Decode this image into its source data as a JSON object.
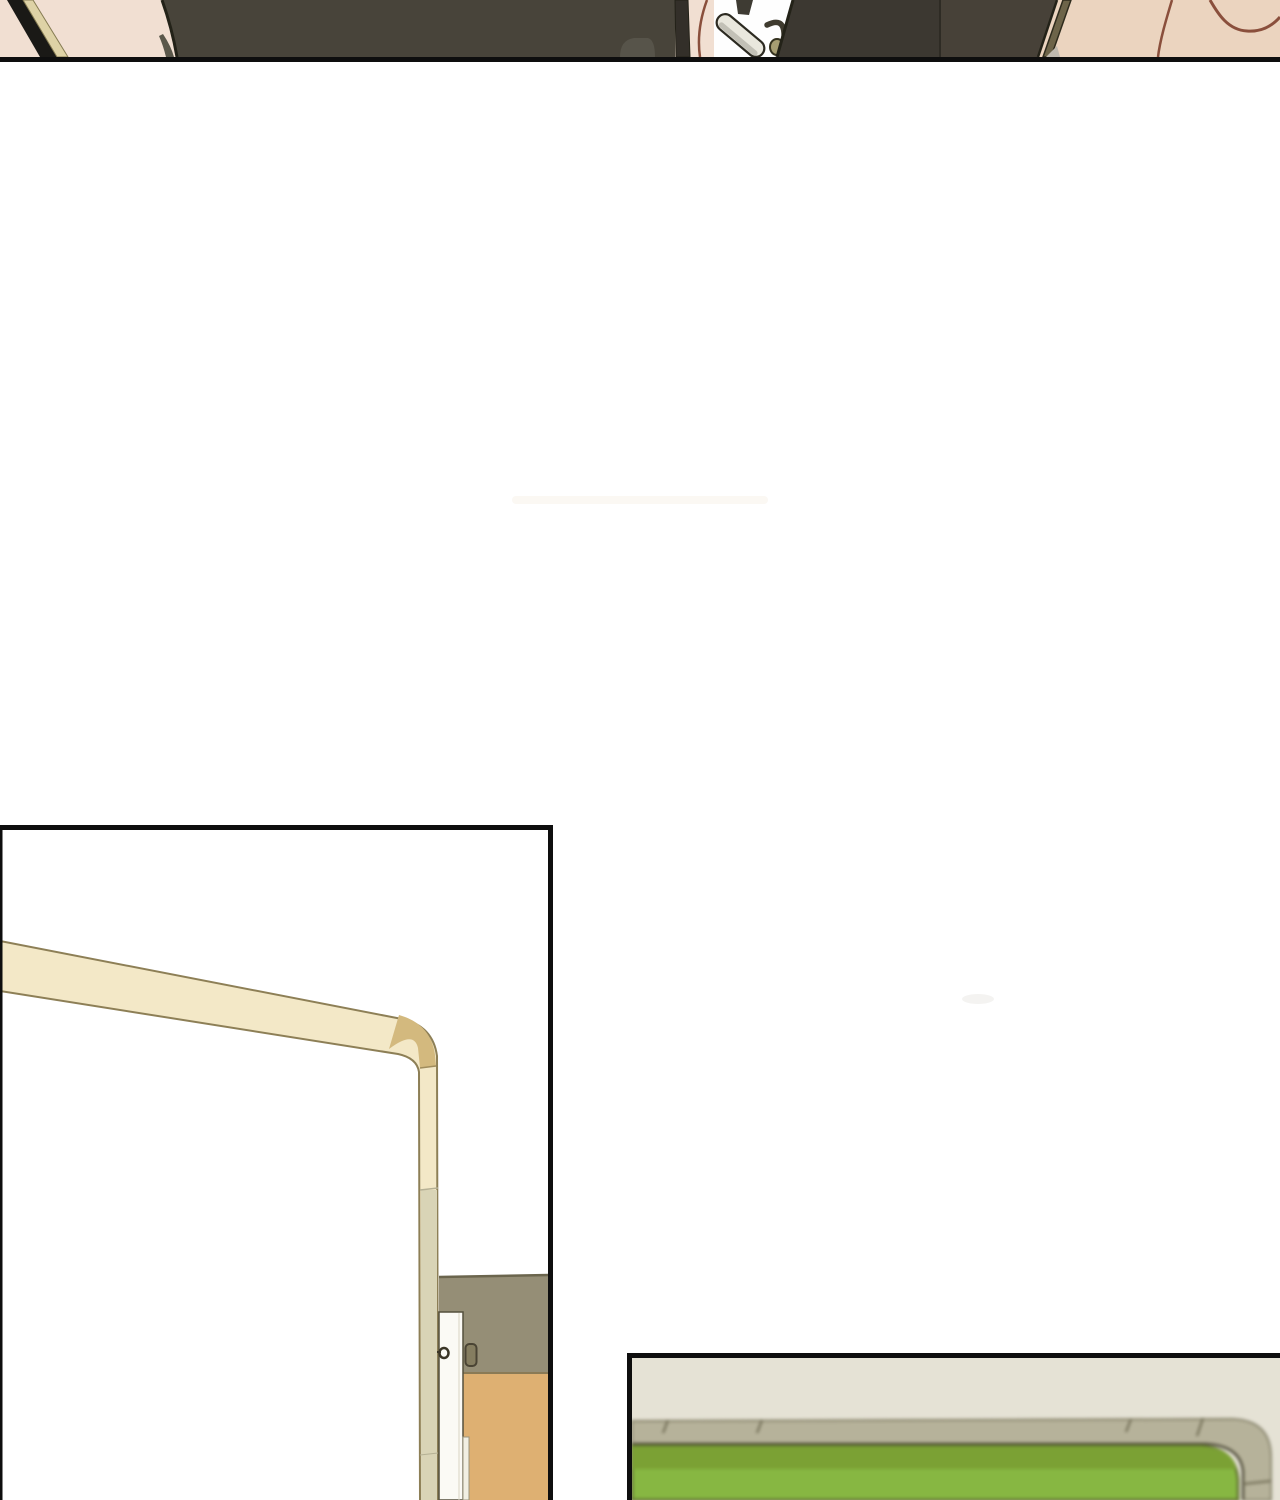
{
  "page": {
    "kind": "wordless webtoon page",
    "note": "no visible text anywhere on the page",
    "background": "#ffffff"
  },
  "panels": [
    {
      "name": "panel-top-crop",
      "alt": "cropped bottom sliver of a panel: dark-clothed seated figures, chair handle, hook and bag strap over warm skin-tone background"
    },
    {
      "name": "panel-door",
      "alt": "tall panel: cream frame rail bending into a vertical post, white door edge with latch, olive wall band and tan door panel"
    },
    {
      "name": "panel-green-board",
      "alt": "blurred close-up panel: green board with rounded gray-green frame edge on a beige background"
    }
  ],
  "colors": {
    "page_bg": "#ffffff",
    "ink": "#0e0e0e",
    "skin_left": "#f1dfd2",
    "skin_right": "#ebd4bf",
    "dark_olive": "#48443a",
    "dark_olive_edge": "#232218",
    "olive_sliver": "#5a574a",
    "gray_wedge": "#57544a",
    "charcoal_1": "#3c3831",
    "charcoal_2": "#474138",
    "charcoal_seam": "#2e2b24",
    "chairleg_dark": "#332f29",
    "hanger_dark": "#3e3b33",
    "khaki_stripe": "#ded2a6",
    "khaki_stripe_edge": "#857b52",
    "black_stripe": "#1a1916",
    "strap_olive": "#6d6449",
    "strap_edge": "#2e2b1d",
    "strap_triangle": "#c0bab0",
    "hair_red": "#8a4f3c",
    "handle_light": "#e9e7dd",
    "handle_shade": "#a3a196",
    "handle_outline": "#2c2a21",
    "hook_dark": "#3f3b2f",
    "hook_knob": "#a69d72",
    "hook_knob_edge": "#35321f",
    "bar_cream": "#f3e8c7",
    "bar_outline": "#8d7f56",
    "corner_tan": "#d3b97e",
    "corner_seam": "#a08c5c",
    "post_khaki": "#d9d4b6",
    "post_joint": "#b5b094",
    "wall_olive": "#958e76",
    "wall_edge": "#6b654d",
    "door_white": "#fbfaf5",
    "door_edge": "#55503d",
    "door_seam": "#d8d4c4",
    "door_strip": "#f1efe3",
    "door_strip_edge": "#9a957e",
    "latch_dark": "#3a3526",
    "bracket_fill": "#857d60",
    "bracket_edge": "#4a4434",
    "door_tan": "#deb072",
    "tan_edge": "#8a7a55",
    "board_bg": "#e5e2d5",
    "strip_gray": "#b6b29a",
    "strip_edge": "#8a866d",
    "strip_outline": "#7b775f",
    "strip_dark_edge": "#504d3a",
    "strip_seam": "#6f6b53",
    "green_dark": "#7ba134",
    "green_main": "#87b742",
    "green_edge": "#5d6e2b",
    "faint_band": "#fbf8f3",
    "faint_smudge": "#f4f3f1"
  }
}
